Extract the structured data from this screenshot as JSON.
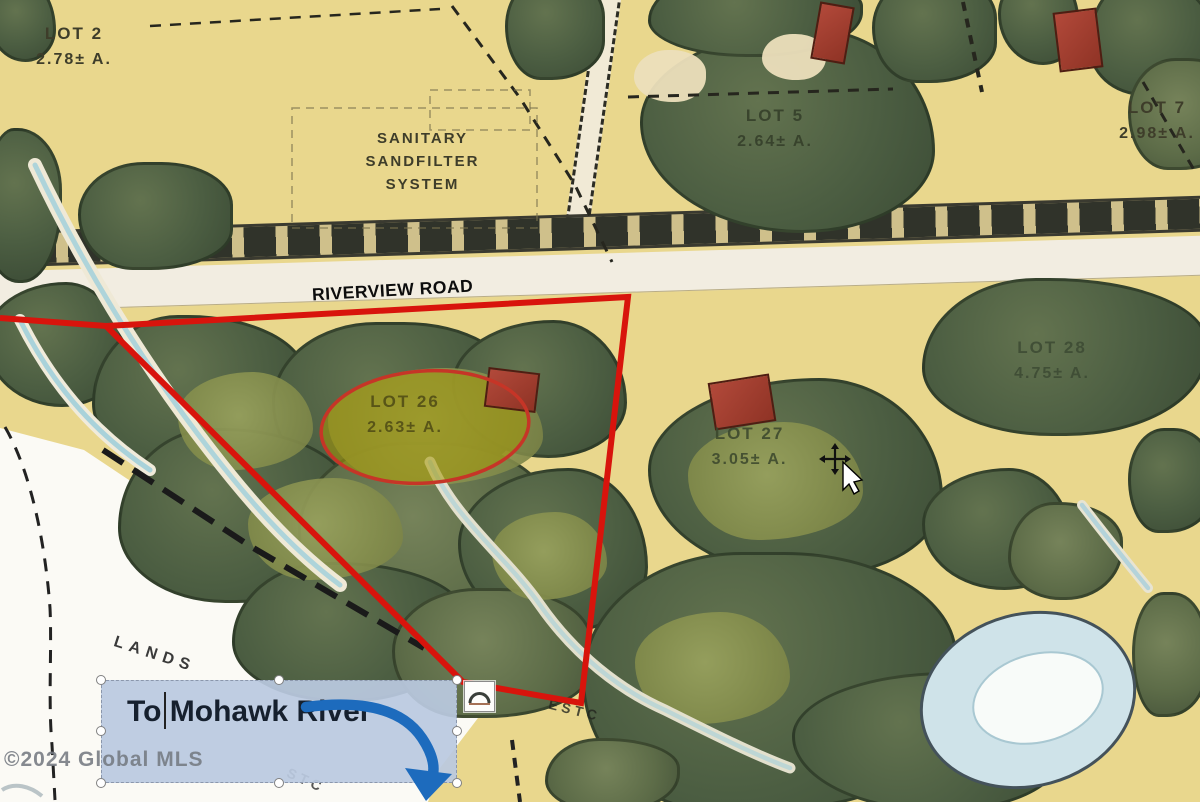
{
  "map": {
    "road_label": "RIVERVIEW ROAD",
    "sanitary": {
      "line1": "SANITARY",
      "line2": "SANDFILTER",
      "line3": "SYSTEM"
    },
    "lands_label": "LANDS",
    "faint_text_1": "ESTC",
    "faint_text_2": "STC",
    "lots": [
      {
        "id": "lot-2",
        "name": "LOT 2",
        "acreage": "2.78± A."
      },
      {
        "id": "lot-5",
        "name": "LOT 5",
        "acreage": "2.64± A."
      },
      {
        "id": "lot-7",
        "name": "LOT 7",
        "acreage": "2.98± A."
      },
      {
        "id": "lot-26",
        "name": "LOT 26",
        "acreage": "2.63± A.",
        "highlighted": true
      },
      {
        "id": "lot-27",
        "name": "LOT 27",
        "acreage": "3.05± A."
      },
      {
        "id": "lot-28",
        "name": "LOT 28",
        "acreage": "4.75± A."
      }
    ]
  },
  "overlay": {
    "textbox_text": "To Mohawk River",
    "watermark": "©2024 Global MLS"
  },
  "icons": {
    "arc_icon": "arch shape in white box",
    "move_cursor_icon": "four-way move pointer",
    "selection_handle": "white circle resize handle"
  },
  "colors": {
    "boundary_red": "#d8140c",
    "highlight_olive": "#a49806",
    "arrow_blue": "#1d6bbd",
    "textbox_fill": "#bac9e0",
    "map_base": "#e9d78d",
    "tree_green": "#4c5e42"
  }
}
